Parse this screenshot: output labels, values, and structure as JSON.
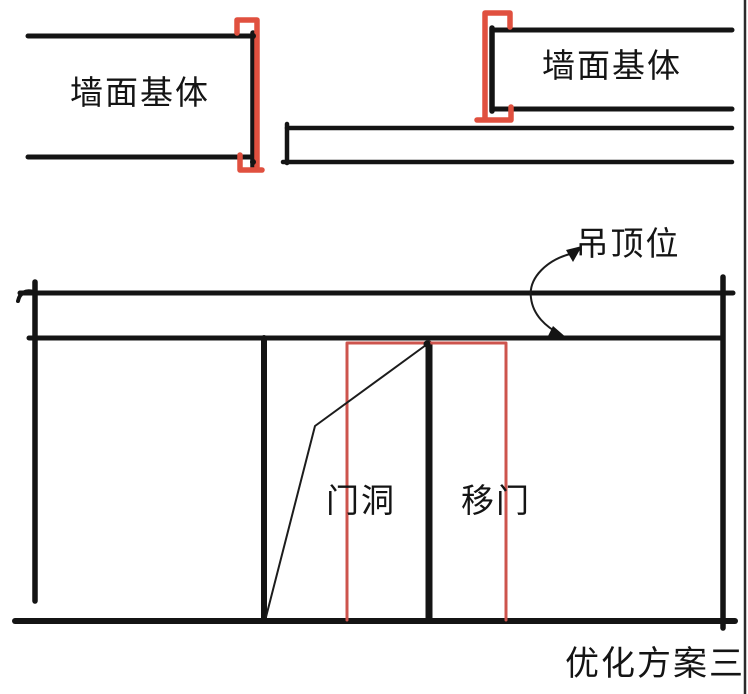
{
  "colors": {
    "ink": "#141414",
    "thin_ink": "#1c1c1c",
    "bracket_red": "#e0503f",
    "door_red": "#cd544d"
  },
  "labels": {
    "wall_base_left": "墙面基体",
    "wall_base_right": "墙面基体",
    "ceiling_position": "吊顶位",
    "door_opening": "门洞",
    "sliding_door": "移门",
    "caption": "优化方案三"
  }
}
